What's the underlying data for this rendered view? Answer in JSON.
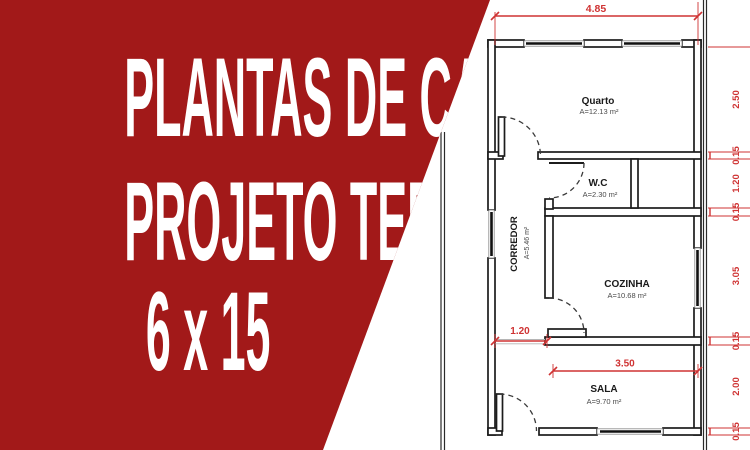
{
  "banner": {
    "line1": "PLANTAS DE CASAS",
    "line2": "PROJETO TERRENO",
    "line3": "6 x 15",
    "bg_color": "#a21919",
    "text_color": "#ffffff"
  },
  "plan": {
    "rooms": {
      "quarto": {
        "name": "Quarto",
        "area": "A=12.13 m²"
      },
      "wc": {
        "name": "W.C",
        "area": "A=2.30 m²"
      },
      "corredor": {
        "name": "CORREDOR",
        "area": "A=5.46 m²"
      },
      "cozinha": {
        "name": "COZINHA",
        "area": "A=10.68 m²"
      },
      "sala": {
        "name": "SALA",
        "area": "A=9.70 m²"
      }
    },
    "dimensions": {
      "top_width": "4.85",
      "hall_opening": "1.20",
      "sala_width": "3.50",
      "right_chain": [
        "2.50",
        "0.15",
        "1.20",
        "0.15",
        "3.05",
        "0.15",
        "2.00",
        "0.15"
      ]
    },
    "colors": {
      "dimension_red": "#cf3333",
      "wall_line": "#1c1c1c"
    }
  }
}
